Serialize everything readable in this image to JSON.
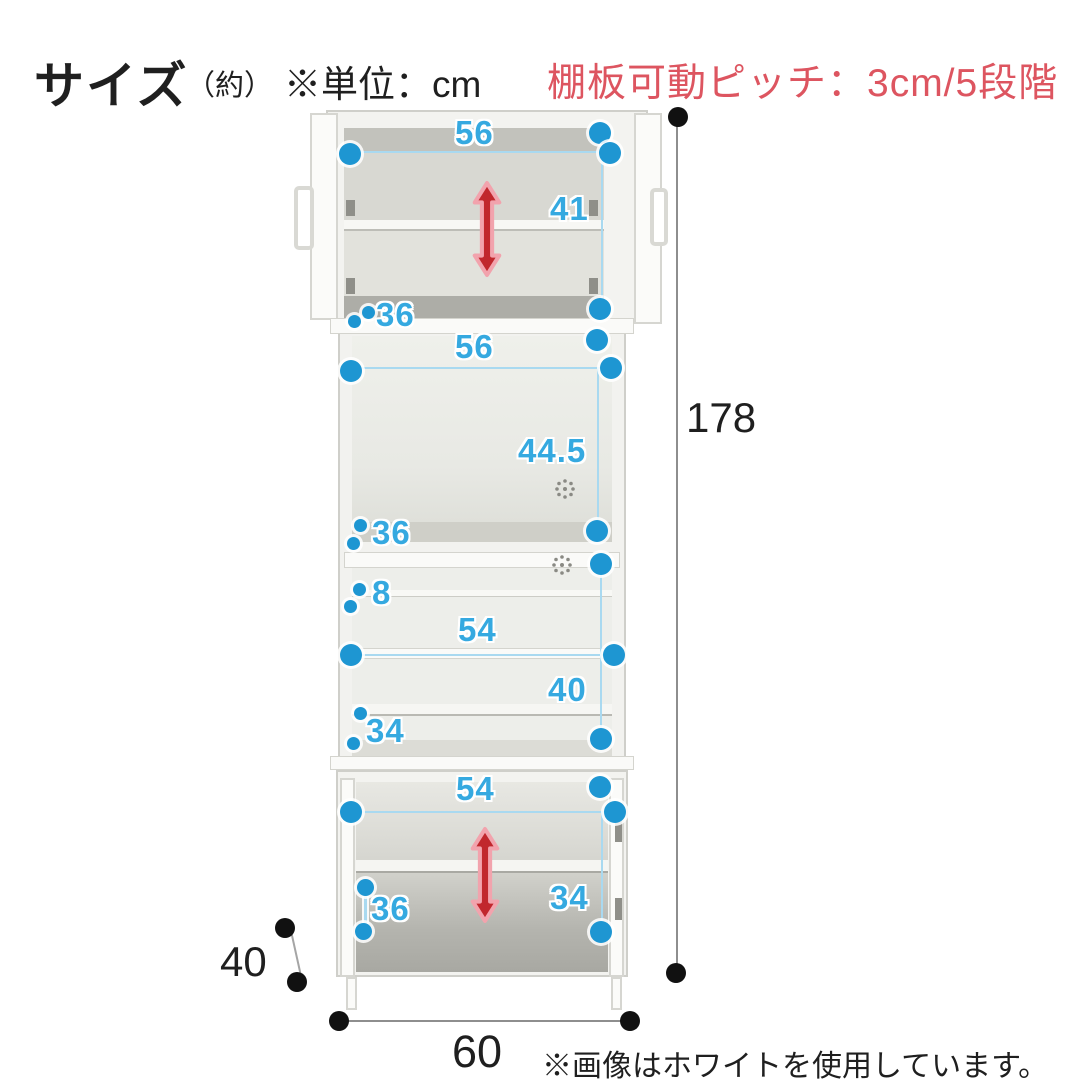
{
  "header": {
    "title": "サイズ",
    "title_note": "（約）",
    "unit_label": "※単位：cm",
    "pitch_note": "棚板可動ピッチ：3cm/5段階"
  },
  "footer": {
    "color_note": "※画像はホワイトを使用しています。"
  },
  "dimensions": {
    "unit": "cm",
    "overall": {
      "height": "178",
      "width": "60",
      "depth": "40"
    },
    "upper_cabinet": {
      "inner_width": "56",
      "inner_height": "41",
      "inner_depth": "36"
    },
    "open_middle": {
      "inner_width": "56",
      "inner_height": "44.5",
      "inner_depth": "36"
    },
    "shelf_section": {
      "top_gap": "8",
      "inner_width": "54",
      "inner_height": "40",
      "inner_depth": "34"
    },
    "lower_cabinet": {
      "inner_width": "54",
      "inner_depth": "36",
      "inner_height": "34"
    }
  },
  "shelf_pitch": {
    "pitch_cm": "3",
    "steps": "5"
  },
  "colors": {
    "dimension_blue": "#35a9e0",
    "dot_blue": "#1e96d2",
    "arrow_red": "#c1272d",
    "arrow_glow": "#f2a3ad",
    "note_red": "#dd5560",
    "line_gray": "#8e8e8e"
  }
}
